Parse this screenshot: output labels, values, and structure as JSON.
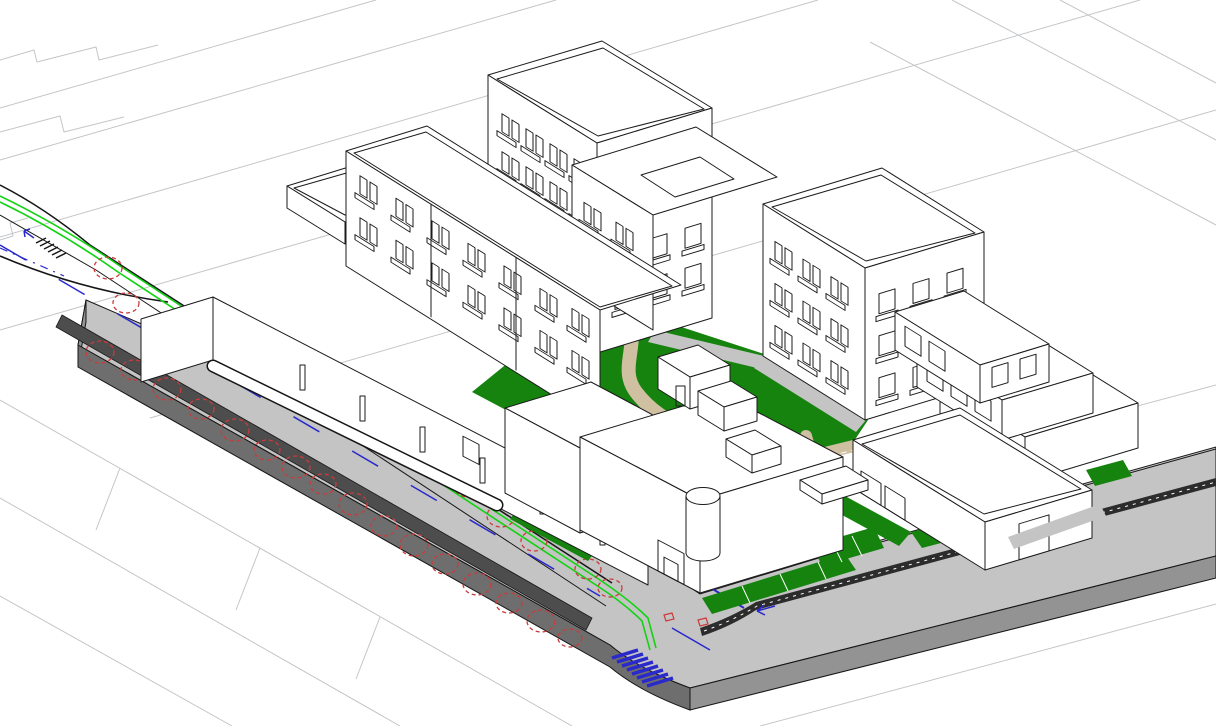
{
  "meta": {
    "title": "Axonometric 3D CAD site view of an urban block",
    "view_type": "axonometric wireframe massing model",
    "visible_text": "none"
  },
  "palette": {
    "background": "#ffffff",
    "parcel_line": "#c3c6c9",
    "outline": "#1b1b1b",
    "building_white": "#ffffff",
    "road_top": "#c4c4c4",
    "side_dark": "#6e6e6e",
    "side_mid": "#939393",
    "band_gray": "#4d4d4d",
    "hatch_dark": "#2c2c2c",
    "lawn_green": "#15830e",
    "line_green": "#12d312",
    "marking_blue": "#2929cc",
    "tree_red": "#cc3a3a",
    "path_tan": "#cfc0a2",
    "beige": "#ded6c6"
  },
  "scene": {
    "background": "white ground plane with light gray cadastral parcel outlines",
    "roads": {
      "main_road": "raised gray avenue running from upper-left to bottom-center with green cycle lines, dashed blue lane markings, blue zebra crosswalk and rows of red dashed tree symbols",
      "cross_road": "gray street running from bottom-center corner to the right edge with dark hatched parking band and green verge strips with white bay lines"
    },
    "landscape": {
      "courtyard": "central green courtyard with winding tan footpath, tan cross-shaped plaza, white dashed lines and small white pavilions",
      "tree_symbol": "red dashed scalloped circle",
      "tree_count": 27
    },
    "buildings": [
      {
        "id": "tower-rear",
        "label": "tall rear tower with 4x4 balcony grid and roof parapet"
      },
      {
        "id": "mid-wing",
        "label": "mid wing with rectangular roof courtyard opening"
      },
      {
        "id": "right-tower",
        "label": "right tower with balcony grid on two faces"
      },
      {
        "id": "stepped-terrace-building",
        "label": "three-storey stepped terrace building"
      },
      {
        "id": "slab-building",
        "label": "long street-front slab with window rows, podium wall, ledge and pilotis columns"
      },
      {
        "id": "corner-building",
        "label": "bottom-center building with cylindrical stair tower and entrance door"
      },
      {
        "id": "annex",
        "label": "low annex box beside corner building"
      },
      {
        "id": "low-street-building",
        "label": "bottom-right low building with two doors and drive-through passage"
      },
      {
        "id": "pavilions",
        "label": "four small white courtyard sheds"
      }
    ],
    "markings": {
      "crosswalk_bottom": "blue zebra stripes",
      "crosswalk_upper_left": "black tick ladder with small blue arrow",
      "lane_line": "blue dashed center line",
      "cycle_lines": "double bright green lines with corner bend",
      "stop_line_arrow": "blue stop line and left arrow near corner"
    }
  }
}
